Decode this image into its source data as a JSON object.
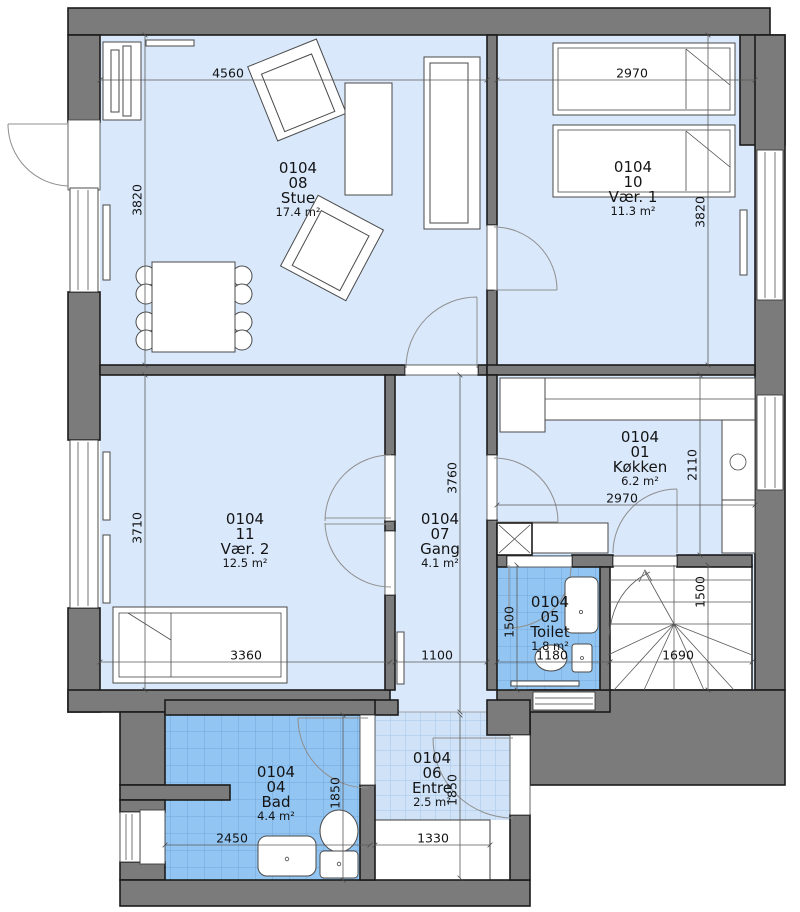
{
  "rooms": {
    "stue": {
      "unit": "0104",
      "number": "08",
      "name": "Stue",
      "area": "17.4 m²"
    },
    "vaer1": {
      "unit": "0104",
      "number": "10",
      "name": "Vær. 1",
      "area": "11.3 m²"
    },
    "koekken": {
      "unit": "0104",
      "number": "01",
      "name": "Køkken",
      "area": "6.2 m²"
    },
    "vaer2": {
      "unit": "0104",
      "number": "11",
      "name": "Vær. 2",
      "area": "12.5 m²"
    },
    "gang": {
      "unit": "0104",
      "number": "07",
      "name": "Gang",
      "area": "4.1 m²"
    },
    "toilet": {
      "unit": "0104",
      "number": "05",
      "name": "Toilet",
      "area": "1.8 m²"
    },
    "bad": {
      "unit": "0104",
      "number": "04",
      "name": "Bad",
      "area": "4.4 m²"
    },
    "entre": {
      "unit": "0104",
      "number": "06",
      "name": "Entre",
      "area": "2.5 m²"
    }
  },
  "dimensions_mm": {
    "stue_width": "4560",
    "vaer1_width": "2970",
    "stue_height": "3820",
    "vaer1_height": "3820",
    "vaer2_height": "3710",
    "vaer2_width": "3360",
    "gang_height": "3760",
    "gang_width": "1100",
    "koekken_height": "2110",
    "koekken_width": "2970",
    "toilet_height": "1500",
    "toilet_width": "1180",
    "stairs_height": "1500",
    "stairs_width": "1690",
    "bad_width": "2450",
    "bad_height": "1850",
    "entre_height": "1850",
    "entrance_step_width": "1330"
  },
  "colors": {
    "wall_fill": "#7b7b7b",
    "wall_outline": "#1c1c1c",
    "room_fill": "#d9e8fb",
    "wet_room_fill": "#93c5f2",
    "wet_room_grid": "#6fa6db",
    "entre_fill": "#cfe2f7",
    "entre_grid": "#a4c6e8",
    "text_color": "#141414"
  }
}
